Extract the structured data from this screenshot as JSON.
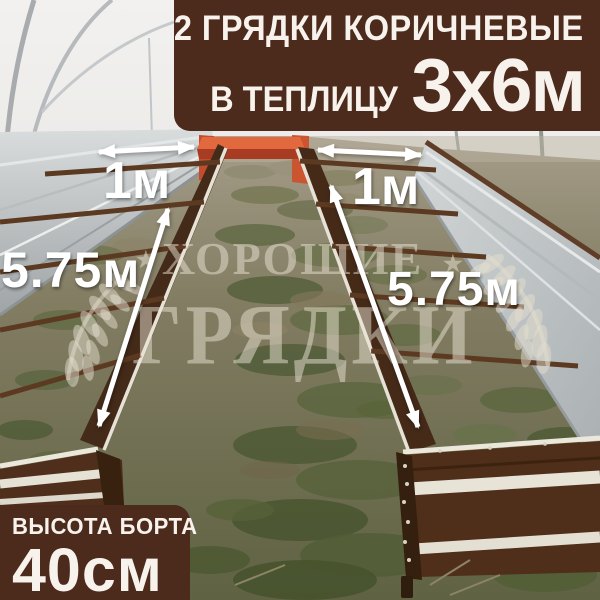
{
  "banner": {
    "line1": "2 ГРЯДКИ КОРИЧНЕВЫЕ",
    "line2_prefix": "В ТЕПЛИЦУ",
    "line2_size": "3х6м",
    "bg_color": "#4c2a1c",
    "text_color": "#f7f2ec"
  },
  "badge": {
    "label": "ВЫСОТА БОРТА",
    "value": "40см"
  },
  "annotations": {
    "left_bed_width": "1м",
    "right_bed_width": "1м",
    "left_bed_length": "5.75м",
    "right_bed_length": "5.75м",
    "arrow_color": "#ffffff"
  },
  "watermark": {
    "word1": "ХОРОШИЕ",
    "word2": "ГРЯДКИ",
    "star": "★",
    "color": "rgba(234,228,212,0.5)"
  },
  "photo_colors": {
    "bed_brown": "#4f2e1a",
    "bed_rim_white": "#e7e2d6",
    "end_panel_orange": "#e2693d",
    "galvanized_steel": "#c0c4c6",
    "greenhouse_wall": "#efeeec",
    "soil": "#837d63",
    "grass": "#57623b"
  }
}
